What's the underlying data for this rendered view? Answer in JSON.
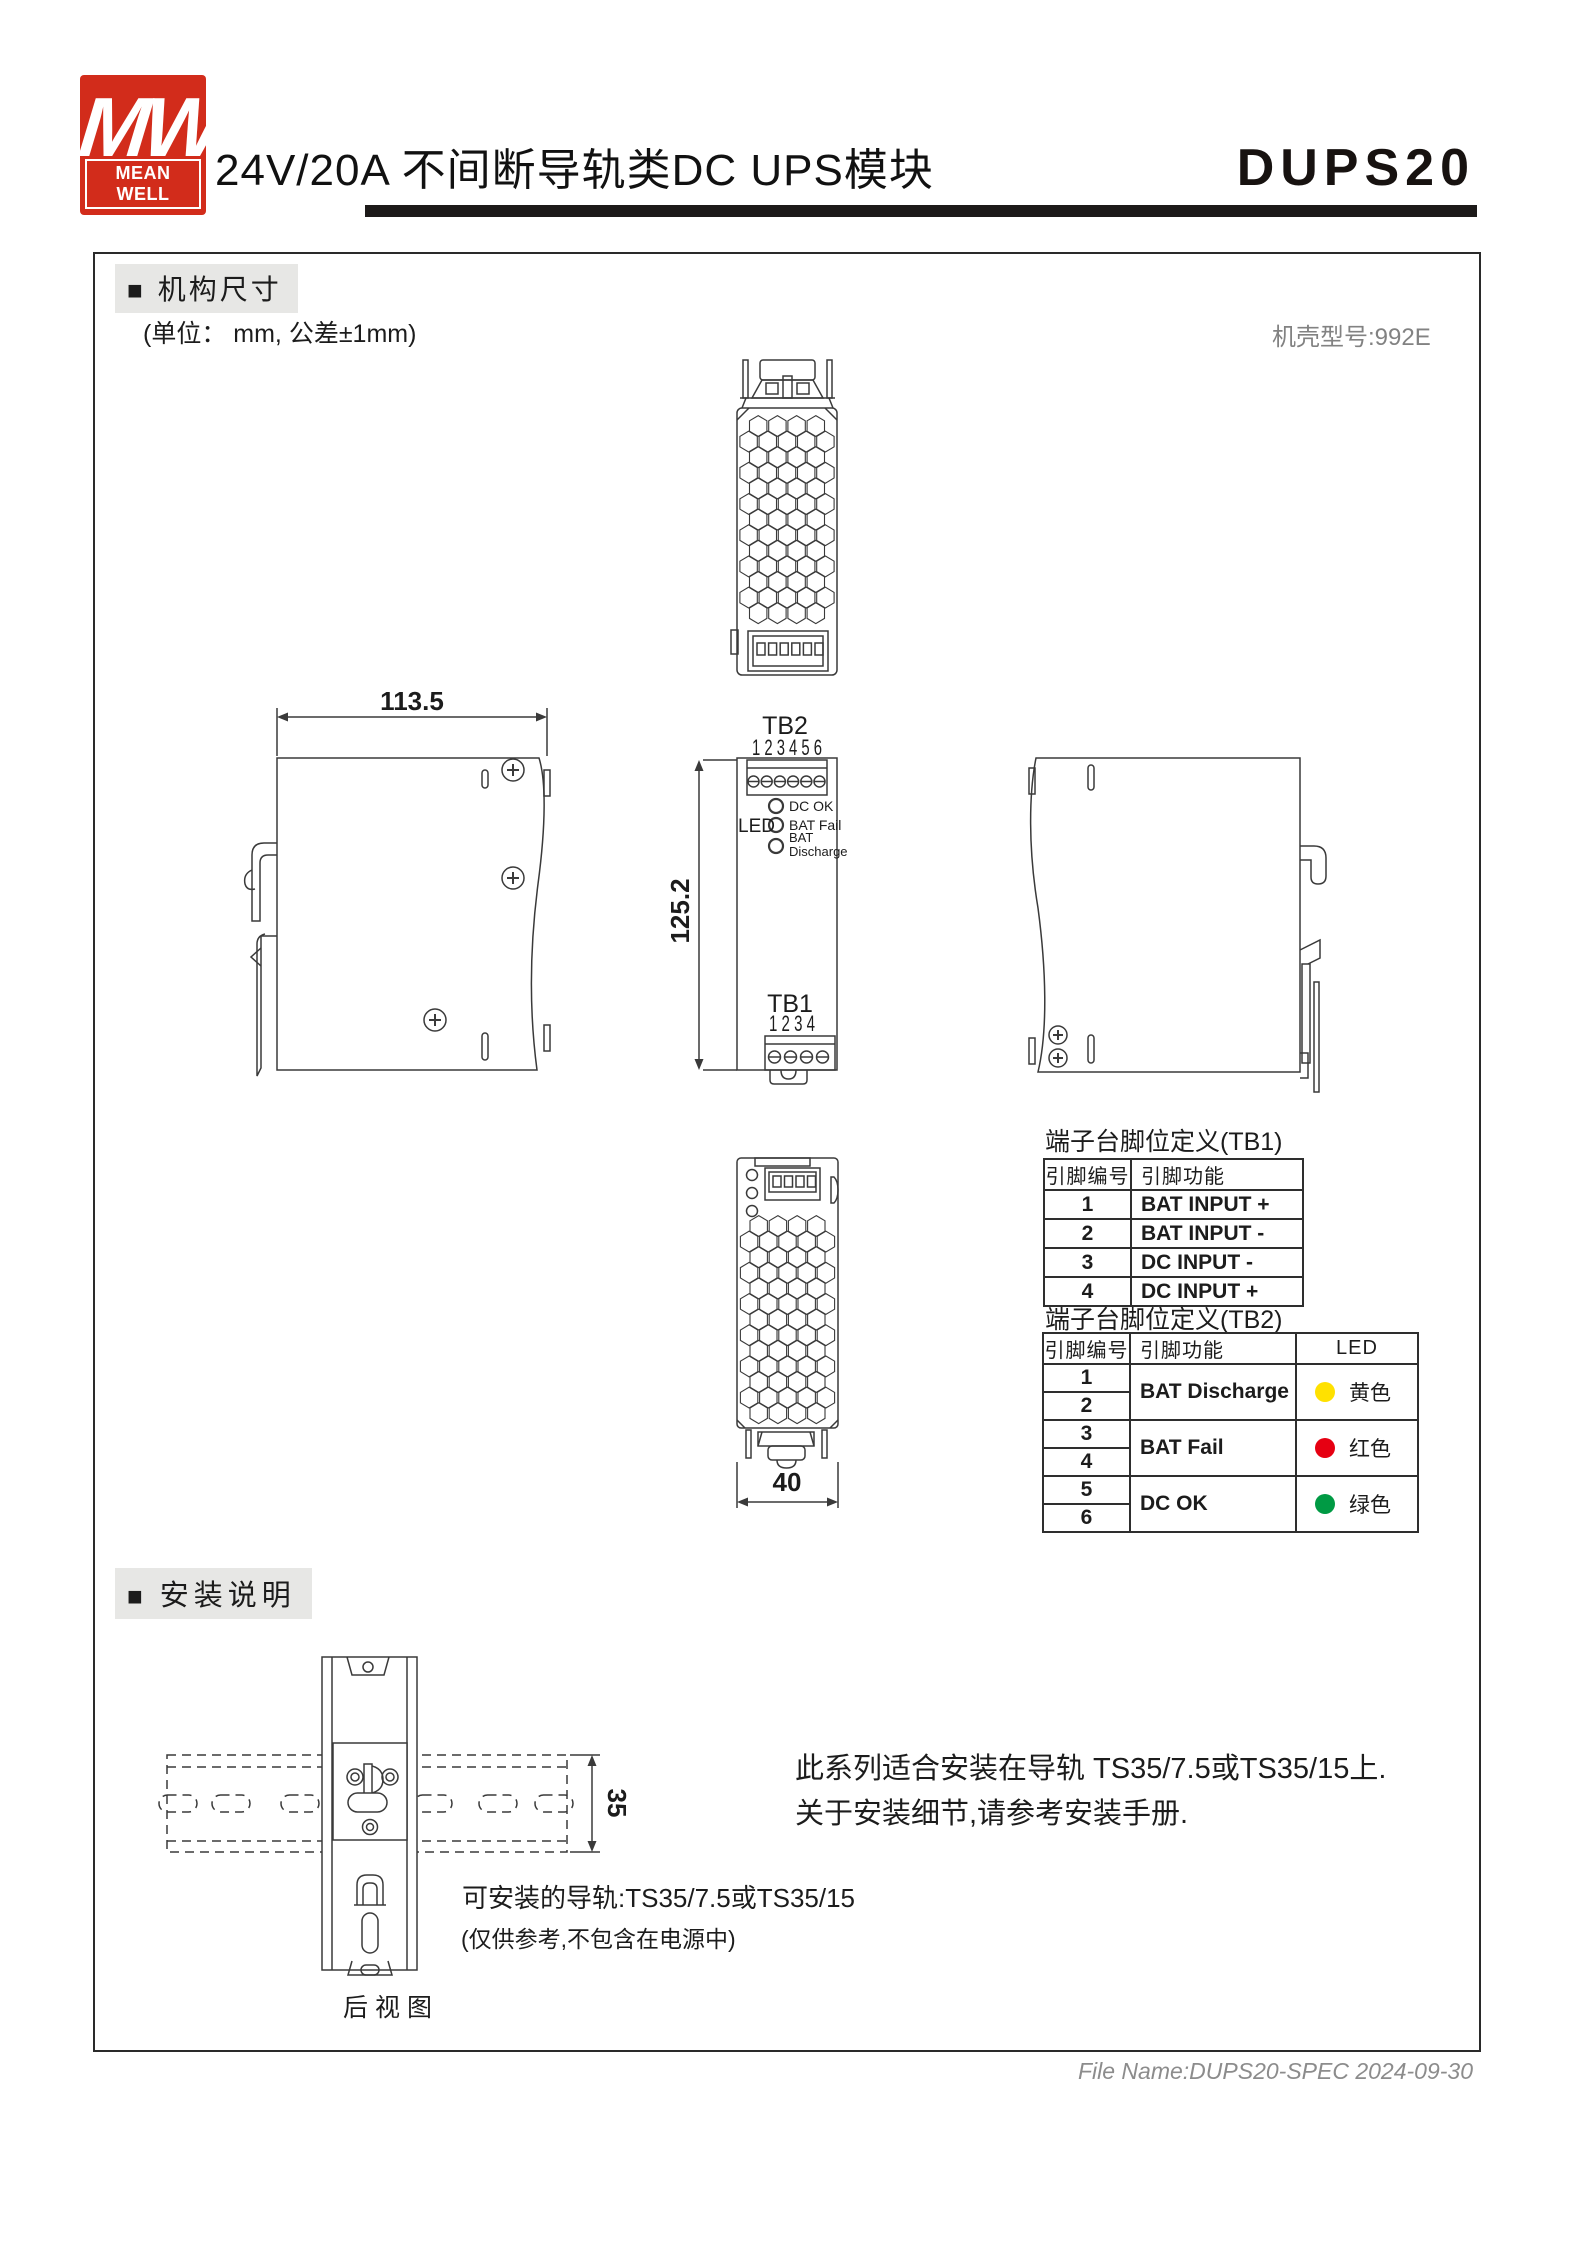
{
  "header": {
    "logo_mw": "MW",
    "logo_brand": "MEAN WELL",
    "title": "24V/20A 不间断导轨类DC UPS模块",
    "model": "DUPS20"
  },
  "mech": {
    "bullet": "■",
    "heading": "机构尺寸",
    "unit_note": "(单位： mm, 公差±1mm)",
    "case_model": "机壳型号:992E",
    "dims": {
      "width": "113.5",
      "height": "125.2",
      "depth": "40"
    }
  },
  "front_view": {
    "tb2_label": "TB2",
    "tb2_pins": "1 2 3 4 5 6",
    "led_label": "LED",
    "led1": "DC OK",
    "led2": "BAT Fail",
    "led3a": "BAT",
    "led3b": "Discharge",
    "tb1_label": "TB1",
    "tb1_pins": "1 2 3 4"
  },
  "tb1_table": {
    "title": "端子台脚位定义(TB1)",
    "col_pin": "引脚编号",
    "col_func": "引脚功能",
    "rows": [
      {
        "pin": "1",
        "func": "BAT INPUT +"
      },
      {
        "pin": "2",
        "func": "BAT INPUT -"
      },
      {
        "pin": "3",
        "func": "DC INPUT -"
      },
      {
        "pin": "4",
        "func": "DC INPUT +"
      }
    ]
  },
  "tb2_table": {
    "title": "端子台脚位定义(TB2)",
    "col_pin": "引脚编号",
    "col_func": "引脚功能",
    "col_led": "LED",
    "groups": [
      {
        "pin_a": "1",
        "pin_b": "2",
        "func": "BAT Discharge",
        "led_color": "#ffe100",
        "led_name": "黄色"
      },
      {
        "pin_a": "3",
        "pin_b": "4",
        "func": "BAT Fail",
        "led_color": "#e60012",
        "led_name": "红色"
      },
      {
        "pin_a": "5",
        "pin_b": "6",
        "func": "DC OK",
        "led_color": "#009a44",
        "led_name": "绿色"
      }
    ]
  },
  "install": {
    "bullet": "■",
    "heading": "安装说明",
    "rail_dim": "35",
    "rear_view_label": "后视图",
    "rail_note1": "可安装的导轨:TS35/7.5或TS35/15",
    "rail_note2": "(仅供参考,不包含在电源中)",
    "desc1": "此系列适合安装在导轨 TS35/7.5或TS35/15上.",
    "desc2": "关于安装细节,请参考安装手册."
  },
  "footer": {
    "file_info": "File Name:DUPS20-SPEC  2024-09-30"
  },
  "colors": {
    "brand_red": "#d22c1b",
    "line": "#3a3a3a"
  }
}
